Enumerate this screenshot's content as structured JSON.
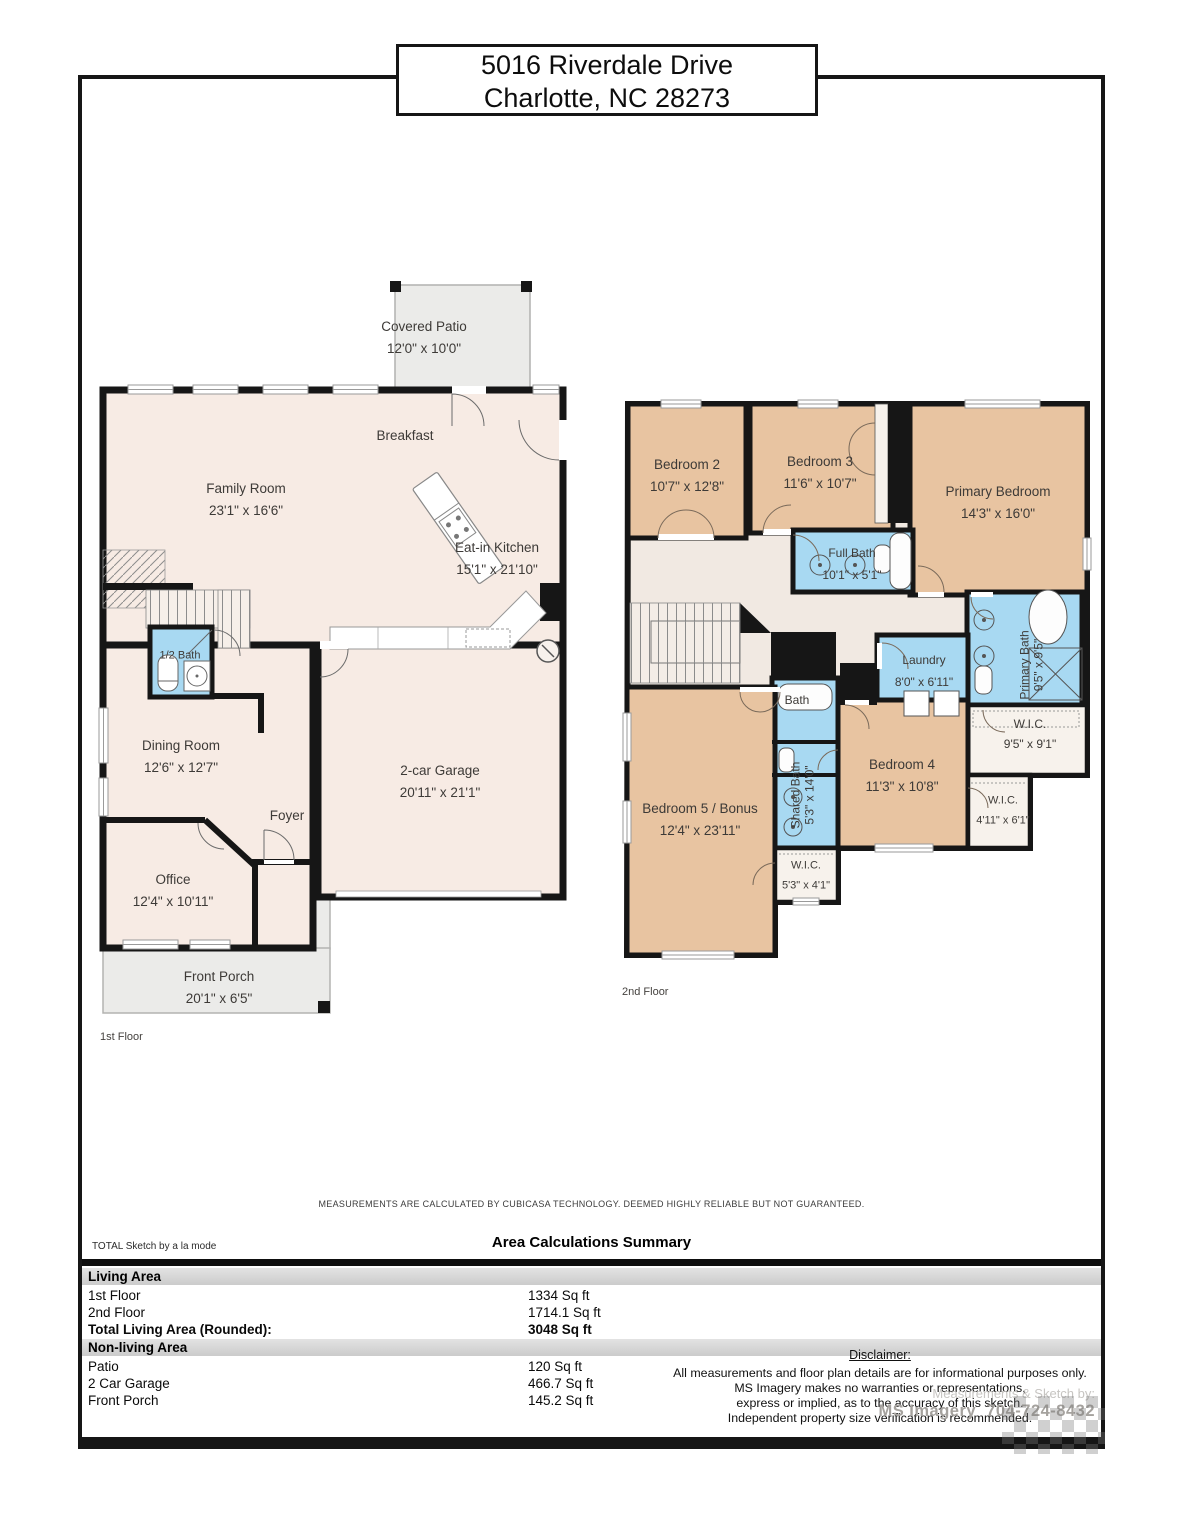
{
  "colors": {
    "wall": "#161616",
    "floor1_room": "#f7ebe4",
    "bedroom": "#e8c4a1",
    "bathroom": "#a8d9f2",
    "hall": "#f1e9e2",
    "porch": "#ebebe9",
    "closet": "#f7f2ec"
  },
  "title": {
    "line1": "5016 Riverdale Drive",
    "line2": "Charlotte, NC 28273"
  },
  "floor1": {
    "caption": "1st Floor",
    "rooms": {
      "patio": {
        "name": "Covered Patio",
        "dims": "12'0\" x 10'0\""
      },
      "breakfast": {
        "name": "Breakfast"
      },
      "family": {
        "name": "Family Room",
        "dims": "23'1\" x 16'6\""
      },
      "kitchen": {
        "name": "Eat-in Kitchen",
        "dims": "15'1\" x 21'10\""
      },
      "half_bath": {
        "name": "1/2 Bath"
      },
      "dining": {
        "name": "Dining Room",
        "dims": "12'6\" x 12'7\""
      },
      "garage": {
        "name": "2-car Garage",
        "dims": "20'11\" x 21'1\""
      },
      "foyer": {
        "name": "Foyer"
      },
      "office": {
        "name": "Office",
        "dims": "12'4\" x 10'11\""
      },
      "porch": {
        "name": "Front Porch",
        "dims": "20'1\" x 6'5\""
      }
    }
  },
  "floor2": {
    "caption": "2nd Floor",
    "rooms": {
      "bedroom2": {
        "name": "Bedroom 2",
        "dims": "10'7\" x 12'8\""
      },
      "bedroom3": {
        "name": "Bedroom 3",
        "dims": "11'6\" x 10'7\""
      },
      "primary": {
        "name": "Primary Bedroom",
        "dims": "14'3\" x 16'0\""
      },
      "full_bath": {
        "name": "Full Bath",
        "dims": "10'1\" x 5'1\""
      },
      "laundry": {
        "name": "Laundry",
        "dims": "8'0\" x 6'11\""
      },
      "primary_bath": {
        "name": "Primary Bath",
        "dims": "9'5\" x 9'5\""
      },
      "wic_primary": {
        "name": "W.I.C.",
        "dims": "9'5\" x 9'1\""
      },
      "bath": {
        "name": "Bath"
      },
      "shared_bath": {
        "name": "Shared Bath",
        "dims": "5'3\" x 14'0\""
      },
      "bedroom4": {
        "name": "Bedroom 4",
        "dims": "11'3\" x 10'8\""
      },
      "wic4": {
        "name": "W.I.C.",
        "dims": "4'11\" x 6'1\""
      },
      "bedroom5": {
        "name": "Bedroom 5 / Bonus",
        "dims": "12'4\" x 23'11\""
      },
      "wic5": {
        "name": "W.I.C.",
        "dims": "5'3\" x 4'1\""
      }
    }
  },
  "footer_note": "MEASUREMENTS ARE CALCULATED BY CUBICASA TECHNOLOGY. DEEMED HIGHLY RELIABLE BUT NOT GUARANTEED.",
  "summary": {
    "brand": "TOTAL Sketch by a la mode",
    "title": "Area Calculations Summary",
    "living_header": "Living Area",
    "nonliving_header": "Non-living Area",
    "rows_living": [
      {
        "label": "1st Floor",
        "value": "1334 Sq ft"
      },
      {
        "label": "2nd Floor",
        "value": "1714.1 Sq ft"
      },
      {
        "label": "Total Living Area (Rounded):",
        "value": "3048 Sq ft"
      }
    ],
    "rows_nonliving": [
      {
        "label": "Patio",
        "value": "120 Sq ft"
      },
      {
        "label": "2 Car Garage",
        "value": "466.7 Sq ft"
      },
      {
        "label": "Front Porch",
        "value": "145.2 Sq ft"
      }
    ]
  },
  "disclaimer": {
    "heading": "Disclaimer:",
    "lines": [
      "All measurements and floor plan details are for informational purposes only.",
      "MS Imagery makes no warranties or representations,",
      "express or implied, as to the accuracy of this sketch.",
      "Independent property size verification is recommended."
    ]
  },
  "credit": {
    "label": "Measurements & Sketch by:",
    "value": "MS Imagery  704-724-8432"
  }
}
